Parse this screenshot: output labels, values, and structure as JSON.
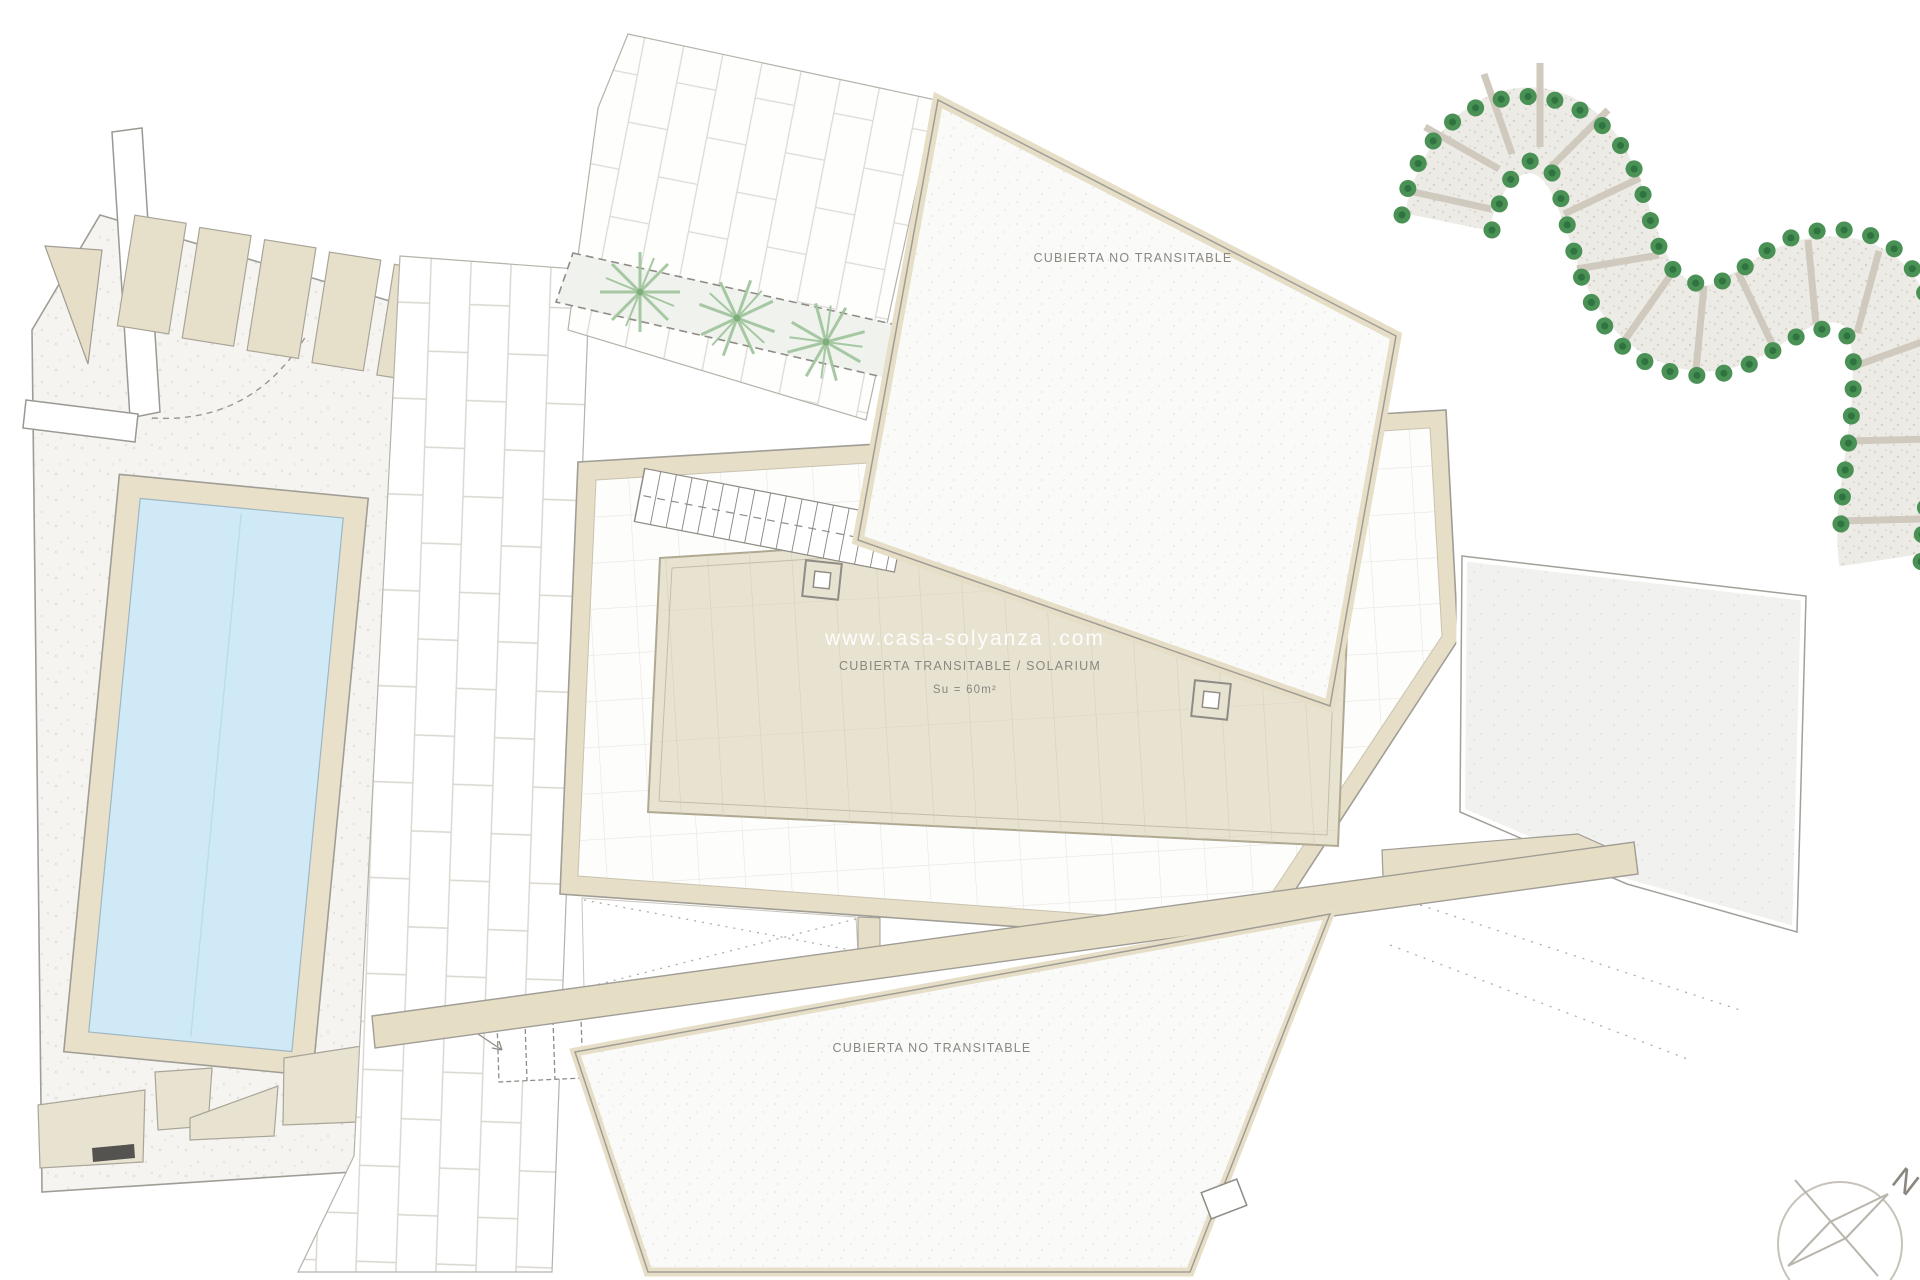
{
  "plan": {
    "type": "architectural-roof-plan",
    "labels": {
      "roof_top": "CUBIERTA NO TRANSITABLE",
      "solarium": "CUBIERTA TRANSITABLE / SOLARIUM",
      "solarium_area": "Su = 60m²",
      "roof_bottom": "CUBIERTA NO TRANSITABLE"
    },
    "watermark": "www.casa-solyanza .com",
    "compass_letter": "N",
    "icons": {
      "palm_tree": "palm-tree-icon",
      "shrub": "shrub-icon",
      "compass": "compass-rose-icon",
      "stairs": "stairs-icon"
    },
    "colors": {
      "wall_beige": "#e6dec6",
      "deck_beige": "#e8e2d1",
      "pool_water": "#cfe9f6",
      "shrub_green": "#4a9155",
      "palm_green": "#9dc49a",
      "line_gray": "#9b9892",
      "label_gray": "#8a877f",
      "stone": "#edebe6"
    }
  }
}
